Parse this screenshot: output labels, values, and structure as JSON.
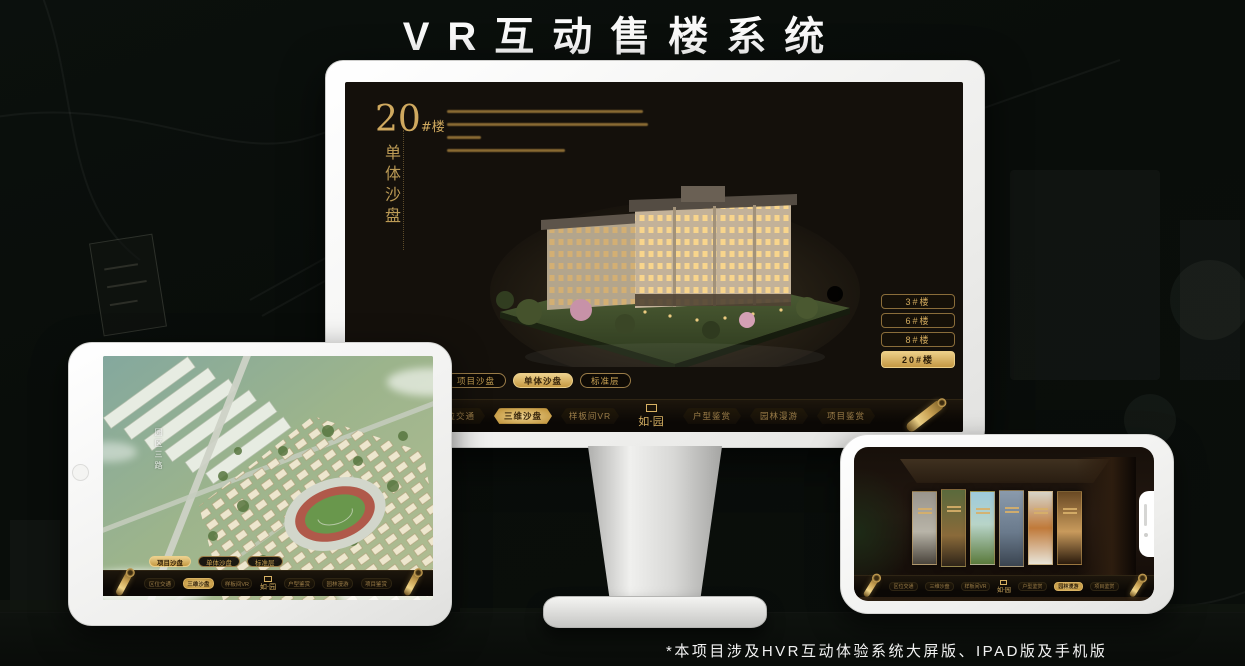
{
  "page": {
    "title": "VR互动售楼系统",
    "footnote": "*本项目涉及HVR互动体验系统大屏版、IPAD版及手机版"
  },
  "colors": {
    "accent_gold": "#c9a254",
    "gold_light": "#ecd08c",
    "screen_dark": "#14100b",
    "background": "#0a0e0b",
    "device_white": "#f4f4f2"
  },
  "brand_logo": "如·园",
  "monitor": {
    "hero": {
      "number": "20",
      "suffix": "#楼",
      "subtitle": "单体沙盘"
    },
    "floor_buttons": [
      {
        "label": "3#楼",
        "active": false
      },
      {
        "label": "6#楼",
        "active": false
      },
      {
        "label": "8#楼",
        "active": false
      },
      {
        "label": "20#楼",
        "active": true
      }
    ],
    "tabs": [
      {
        "label": "项目沙盘",
        "active": false
      },
      {
        "label": "单体沙盘",
        "active": true
      },
      {
        "label": "标准层",
        "active": false
      }
    ],
    "nav_items": [
      {
        "label": "区位交通",
        "active": false
      },
      {
        "label": "三维沙盘",
        "active": true
      },
      {
        "label": "样板间VR",
        "active": false
      },
      {
        "label": "户型鉴赏",
        "active": false
      },
      {
        "label": "园林漫游",
        "active": false
      },
      {
        "label": "项目鉴赏",
        "active": false
      }
    ],
    "logo": "如·园"
  },
  "tablet": {
    "road_label": "园区三路",
    "tabs": [
      {
        "label": "项目沙盘",
        "active": true
      },
      {
        "label": "单体沙盘",
        "active": false
      },
      {
        "label": "标准层",
        "active": false
      }
    ],
    "nav_items": [
      {
        "label": "区位交通",
        "active": false
      },
      {
        "label": "三维沙盘",
        "active": true
      },
      {
        "label": "样板间VR",
        "active": false
      },
      {
        "label": "户型鉴赏",
        "active": false
      },
      {
        "label": "园林漫游",
        "active": false
      },
      {
        "label": "项目鉴赏",
        "active": false
      }
    ],
    "logo": "如·园"
  },
  "phone": {
    "nav_items": [
      {
        "label": "区位交通",
        "active": false
      },
      {
        "label": "三维沙盘",
        "active": false
      },
      {
        "label": "样板间VR",
        "active": false
      },
      {
        "label": "户型鉴赏",
        "active": false
      },
      {
        "label": "园林漫游",
        "active": true
      },
      {
        "label": "项目鉴赏",
        "active": false
      }
    ],
    "logo": "如·园"
  }
}
